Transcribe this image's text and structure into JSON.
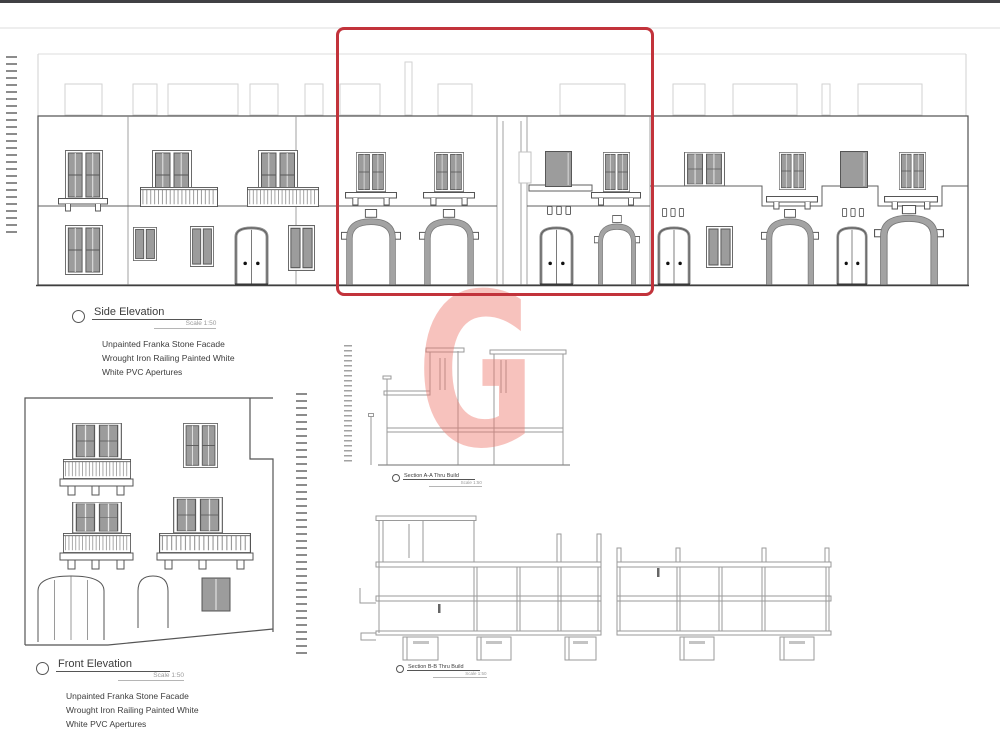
{
  "page": {
    "background": "#ffffff",
    "top_bar_color": "#404044"
  },
  "watermark": {
    "letter": "G",
    "color": "#ee776c"
  },
  "highlight_box": {
    "shape": "rectangle",
    "color": "#c2333b"
  },
  "labels": {
    "side_elevation": {
      "title": "Side Elevation",
      "scale": "Scale 1:50",
      "notes": [
        "Unpainted Franka Stone Facade",
        "Wrought Iron Railing Painted White",
        "White PVC Apertures"
      ]
    },
    "front_elevation": {
      "title": "Front Elevation",
      "scale": "Scale 1:50",
      "notes": [
        "Unpainted Franka Stone Facade",
        "Wrought Iron Railing Painted White",
        "White PVC Apertures"
      ]
    },
    "section_a": {
      "title": "Section A-A Thru Build",
      "scale": "Scale 1:50"
    },
    "section_b": {
      "title": "Section B-B Thru Build",
      "scale": "Scale 1:50"
    }
  }
}
